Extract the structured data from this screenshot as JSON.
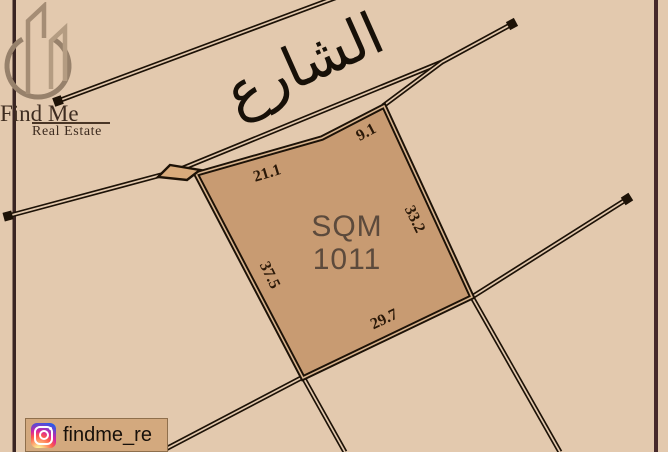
{
  "window": {
    "width": 668,
    "height": 452
  },
  "colors": {
    "background": "#e3c9ae",
    "parcel_fill": "#c89b72",
    "line": "#1d1207",
    "frame_left": "#3a2523",
    "frame_right": "#46292b",
    "dimension_text": "#2a1808",
    "area_text": "#5c4a3c",
    "street_text": "#171008",
    "logo_primary": "#97816b",
    "logo_secondary": "#b49c82",
    "logo_text": "#3e2c20",
    "badge_bg": "#d3a97e",
    "junction_fill": "#d9ab7c"
  },
  "logo": {
    "brand": "Find Me",
    "tagline": "Real Estate"
  },
  "street": {
    "label": "الشارع"
  },
  "plot": {
    "area_unit": "SQM",
    "area_value": "1011",
    "dimensions": {
      "top": "21.1",
      "top_right": "9.1",
      "right": "33.2",
      "left": "37.5",
      "bottom": "29.7"
    }
  },
  "social": {
    "handle": "findme_re",
    "icon": "instagram-icon"
  }
}
